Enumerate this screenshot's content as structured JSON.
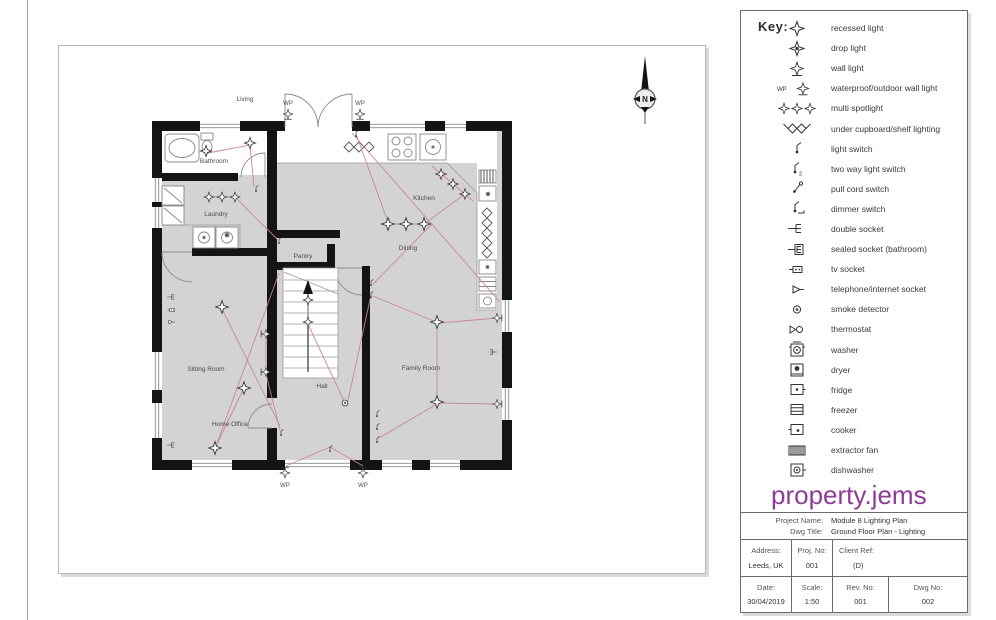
{
  "key": {
    "title": "Key:",
    "wp_prefix": "WP",
    "items": [
      {
        "icon": "recessed-light",
        "label": "recessed light"
      },
      {
        "icon": "drop-light",
        "label": "drop light"
      },
      {
        "icon": "wall-light",
        "label": "wall light"
      },
      {
        "icon": "waterproof-outdoor-wall-light",
        "label": "waterproof/outdoor wall light"
      },
      {
        "icon": "multi-spotlight",
        "label": "multi spotlight"
      },
      {
        "icon": "under-cupboard-shelf-lighting",
        "label": "under cupboard/shelf lighting"
      },
      {
        "icon": "light-switch",
        "label": "light switch"
      },
      {
        "icon": "two-way-light-switch",
        "label": "two way light switch"
      },
      {
        "icon": "pull-cord-switch",
        "label": "pull cord switch"
      },
      {
        "icon": "dimmer-switch",
        "label": "dimmer switch"
      },
      {
        "icon": "double-socket",
        "label": "double socket"
      },
      {
        "icon": "sealed-socket",
        "label": "sealed socket (bathroom)"
      },
      {
        "icon": "tv-socket",
        "label": "tv socket"
      },
      {
        "icon": "telephone-internet-socket",
        "label": "telephone/internet socket"
      },
      {
        "icon": "smoke-detector",
        "label": "smoke detector"
      },
      {
        "icon": "thermostat",
        "label": "thermostat"
      },
      {
        "icon": "washer",
        "label": "washer"
      },
      {
        "icon": "dryer",
        "label": "dryer"
      },
      {
        "icon": "fridge",
        "label": "fridge"
      },
      {
        "icon": "freezer",
        "label": "freezer"
      },
      {
        "icon": "cooker",
        "label": "cooker"
      },
      {
        "icon": "extractor-fan",
        "label": "extractor fan"
      },
      {
        "icon": "dishwasher",
        "label": "dishwasher"
      }
    ]
  },
  "logo": {
    "text": "property.jems",
    "color": "#8d3d96"
  },
  "title_block": {
    "project_name_label": "Project Name:",
    "project_name": "Module 8 Lighting Plan",
    "dwg_title_label": "Dwg Title:",
    "dwg_title": "Ground Floor Plan - Lighting",
    "address_label": "Address:",
    "address": "Leeds, UK",
    "proj_no_label": "Proj. No:",
    "proj_no": "001",
    "client_ref_label": "Client Ref:",
    "client_ref": "(D)",
    "date_label": "Date:",
    "date": "30/04/2019",
    "scale_label": "Scale:",
    "scale": "1:50",
    "rev_no_label": "Rev. No:",
    "rev_no": "001",
    "dwg_no_label": "Dwg No:",
    "dwg_no": "002"
  },
  "plan": {
    "north": "N",
    "rooms": [
      "Living",
      "Bathroom",
      "Laundry",
      "Pantry",
      "Kitchen",
      "Dining",
      "Sitting Room",
      "Home Office",
      "Hall",
      "Family Room"
    ],
    "wp_labels": [
      "WP",
      "WP",
      "WP",
      "WP"
    ],
    "colors": {
      "wall": "#141414",
      "floor": "#d3d3d3",
      "wiring": "#c9858d",
      "fixture": "#777777"
    }
  }
}
